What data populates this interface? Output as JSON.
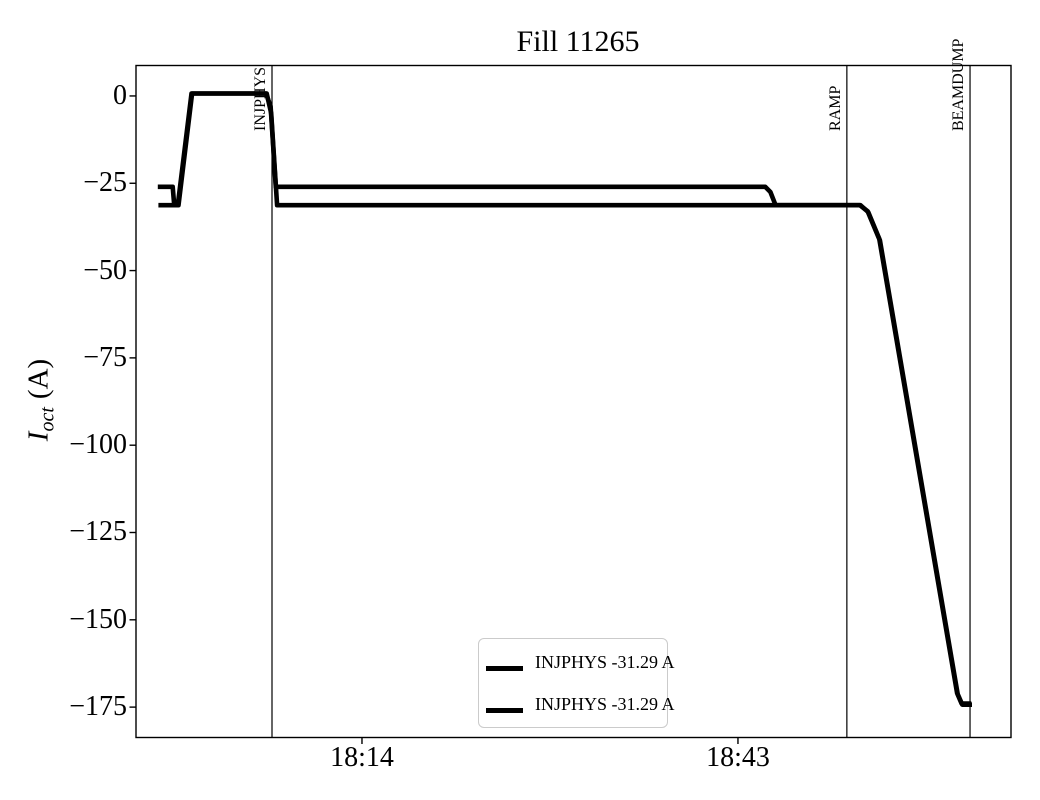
{
  "title": "Fill 11265",
  "ylabel_parts": {
    "symbol": "I",
    "subscript": "oct",
    "unit": "(A)"
  },
  "chart_data": {
    "type": "line",
    "title": "Fill 11265",
    "xlabel": "",
    "ylabel": "I_oct (A)",
    "x_axis_note": "time of day; x values stored as minutes after 18:00",
    "xlim": [
      -3.43,
      64.06
    ],
    "ylim": [
      -183.7,
      8.72
    ],
    "grid": false,
    "x_ticks": [
      {
        "x": 14,
        "label": "18:14"
      },
      {
        "x": 43,
        "label": "18:43"
      }
    ],
    "y_ticks": [
      {
        "y": 0,
        "label": "0"
      },
      {
        "y": -25,
        "label": "−25"
      },
      {
        "y": -50,
        "label": "−50"
      },
      {
        "y": -75,
        "label": "−75"
      },
      {
        "y": -100,
        "label": "−100"
      },
      {
        "y": -125,
        "label": "−125"
      },
      {
        "y": -150,
        "label": "−150"
      },
      {
        "y": -175,
        "label": "−175"
      }
    ],
    "events": [
      {
        "label": "INJPHYS",
        "x": 7.06
      },
      {
        "label": "RAMP",
        "x": 51.4
      },
      {
        "label": "BEAMDUMP",
        "x": 60.9
      }
    ],
    "line_color": "#000000",
    "line_width": 4.6,
    "legend_position": "lower center",
    "series": [
      {
        "name": "INJPHYS -31.29 A",
        "color": "#000000",
        "points": [
          [
            -1.75,
            -26
          ],
          [
            -0.6,
            -26
          ],
          [
            -0.5,
            -30.5
          ],
          [
            -0.2,
            -31
          ],
          [
            0.85,
            0.7
          ],
          [
            6.6,
            0.7
          ],
          [
            6.95,
            -3
          ],
          [
            7.35,
            -26
          ],
          [
            45.1,
            -26
          ],
          [
            45.5,
            -27.5
          ],
          [
            45.9,
            -31.29
          ],
          [
            52.4,
            -31.29
          ],
          [
            53.0,
            -33
          ],
          [
            53.9,
            -41
          ],
          [
            59.9,
            -171
          ],
          [
            60.25,
            -174
          ],
          [
            61.0,
            -174
          ]
        ]
      },
      {
        "name": "INJPHYS -31.29 A",
        "color": "#000000",
        "points": [
          [
            -1.7,
            -31.29
          ],
          [
            -0.15,
            -31.29
          ],
          [
            0.9,
            0.7
          ],
          [
            6.65,
            0.7
          ],
          [
            7.0,
            -5
          ],
          [
            7.45,
            -31.29
          ],
          [
            52.45,
            -31.29
          ],
          [
            53.05,
            -33.3
          ],
          [
            53.95,
            -41.3
          ],
          [
            59.95,
            -171.3
          ],
          [
            60.3,
            -174.3
          ],
          [
            61.05,
            -174.3
          ]
        ]
      }
    ]
  }
}
